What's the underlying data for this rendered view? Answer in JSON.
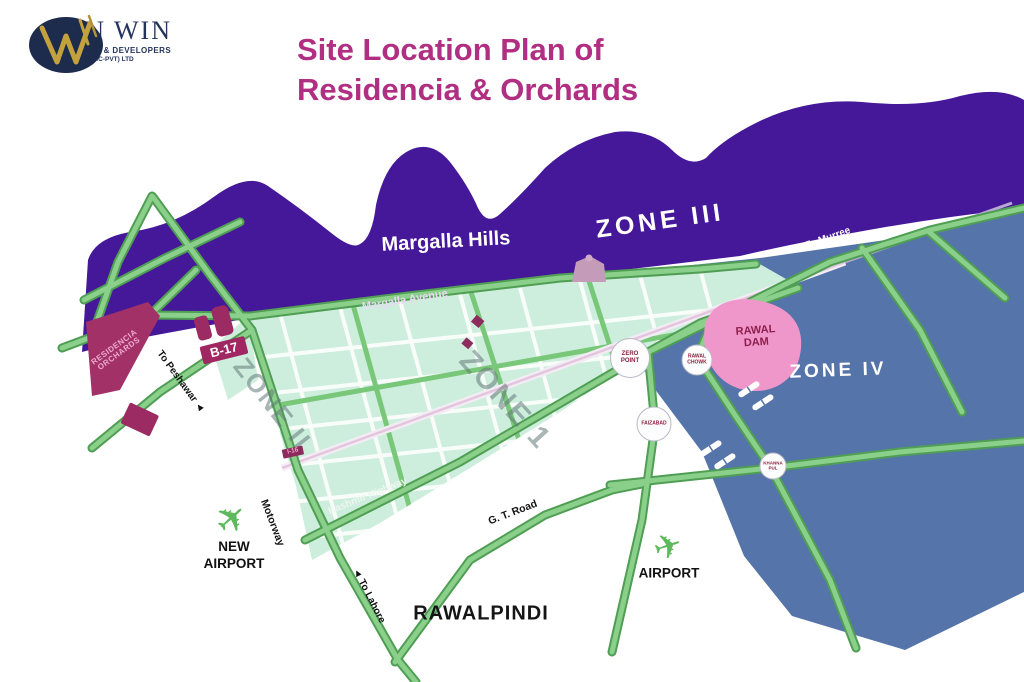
{
  "header": {
    "logo": {
      "name": "WIN WIN",
      "tagline": "MARKETING & DEVELOPERS",
      "subline": "(SMC-PVT) LTD"
    },
    "title_line1": "Site Location Plan of",
    "title_line2": "Residencia & Orchards"
  },
  "map": {
    "regions": {
      "margalla_hills": "Margalla Hills",
      "zone3": "ZONE III",
      "zone4": "ZONE IV",
      "zone2": "ZONE II",
      "zone1": "ZONE 1",
      "rawalpindi": "RAWALPINDI"
    },
    "roads": {
      "margalla_avenue": "Margalla Avenue",
      "kashmir_highway": "Kashmir Highway",
      "gt_road": "G. T. Road",
      "motorway": "Motorway"
    },
    "directions": {
      "to_murree": "To Murree",
      "to_lahore": "To Lahore",
      "to_peshawar": "To Peshawar"
    },
    "sites": {
      "b17": "B-17",
      "residencia_line1": "RESIDENCIA",
      "residencia_line2": "ORCHARDS",
      "sector_badge": "I-16",
      "rawal_dam_line1": "RAWAL",
      "rawal_dam_line2": "DAM"
    },
    "airports": {
      "new_airport_line1": "NEW",
      "new_airport_line2": "AIRPORT",
      "airport": "AIRPORT"
    },
    "interchanges": {
      "zero_point_line1": "ZERO",
      "zero_point_line2": "POINT",
      "rawal_chowk_line1": "RAWAL",
      "rawal_chowk_line2": "CHOWK",
      "faizabad": "FAIZABAD",
      "khanna_line1": "KHANNA",
      "khanna_line2": "PUL"
    },
    "colors": {
      "hills_purple": "#45189a",
      "zone4_blue": "#5574a9",
      "grid_teal": "#cdeedd",
      "road_green": "#8ad08a",
      "road_edge": "#4f9e54",
      "title_magenta": "#b02f82",
      "maroon": "#9c2a63",
      "dam_pink": "#ef97cb",
      "logo_navy": "#1d2b4d",
      "logo_gold": "#c3a13d"
    }
  },
  "icons": {
    "plane": "✈",
    "arrow": "◄"
  }
}
